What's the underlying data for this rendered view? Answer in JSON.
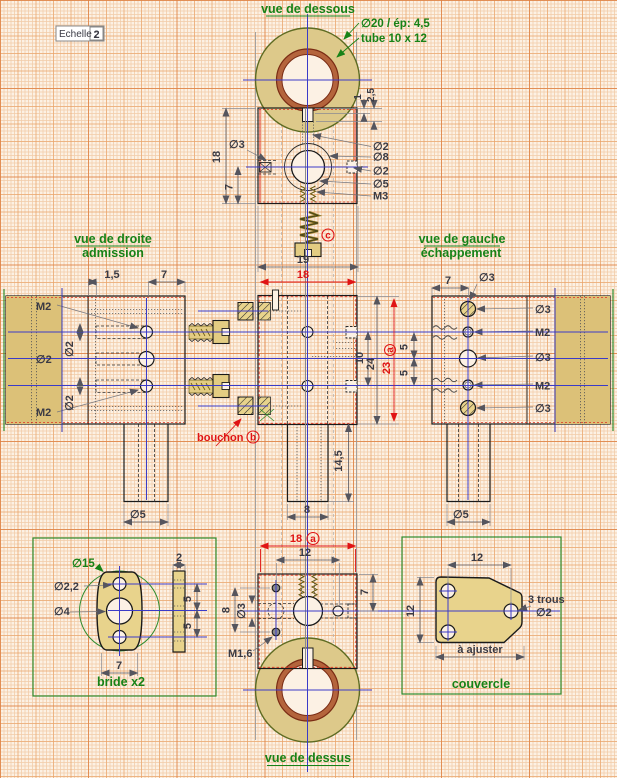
{
  "scale_box": {
    "label": "Echelle :",
    "value": "2"
  },
  "titles": {
    "dessous": "vue de dessous",
    "dessus": "vue de dessus",
    "droite1": "vue de droite",
    "droite2": "admission",
    "gauche1": "vue de gauche",
    "gauche2": "échappement",
    "bride": "bride x2",
    "couvercle": "couvercle"
  },
  "notes": {
    "tube_dia": "∅20 / ép: 4,5",
    "tube_size": "tube 10 x 12",
    "bouchon": "bouchon",
    "trous": "3 trous",
    "trous_dia": "∅2",
    "ajuster": "à ajuster"
  },
  "markers": {
    "a": "a",
    "b": "b",
    "c": "c"
  },
  "front": {
    "d3": "∅3",
    "h18": "18",
    "h7": "7",
    "d2a": "∅2",
    "d8": "∅8",
    "d2b": "∅2",
    "d5": "∅5",
    "m3": "M3",
    "t1": "1",
    "t25": "2,5",
    "w19": "19",
    "w18": "18"
  },
  "left": {
    "m2a": "M2",
    "d2": "∅2",
    "d2v1": "∅2",
    "d2v2": "∅2",
    "m2b": "M2",
    "w15": "1,5",
    "w7": "7",
    "d5": "∅5"
  },
  "center": {
    "v10": "10",
    "v24": "24",
    "v23": "23",
    "s5a": "5",
    "s5b": "5",
    "w8": "8",
    "h145": "14,5",
    "d5": "∅5"
  },
  "right": {
    "w7": "7",
    "d3l": "∅3",
    "d3a": "∅3",
    "m2a": "M2",
    "d3b": "∅3",
    "m2b": "M2",
    "d3c": "∅3"
  },
  "bottom": {
    "w18": "18",
    "w12": "12",
    "h7": "7",
    "h8": "8",
    "d3": "∅3",
    "m16": "M1,6"
  },
  "bride": {
    "d15": "∅15",
    "d22": "∅2,2",
    "d4": "∅4",
    "t2": "2",
    "s5a": "5",
    "s5b": "5",
    "w7": "7"
  },
  "couv": {
    "w12": "12",
    "h12": "12"
  }
}
